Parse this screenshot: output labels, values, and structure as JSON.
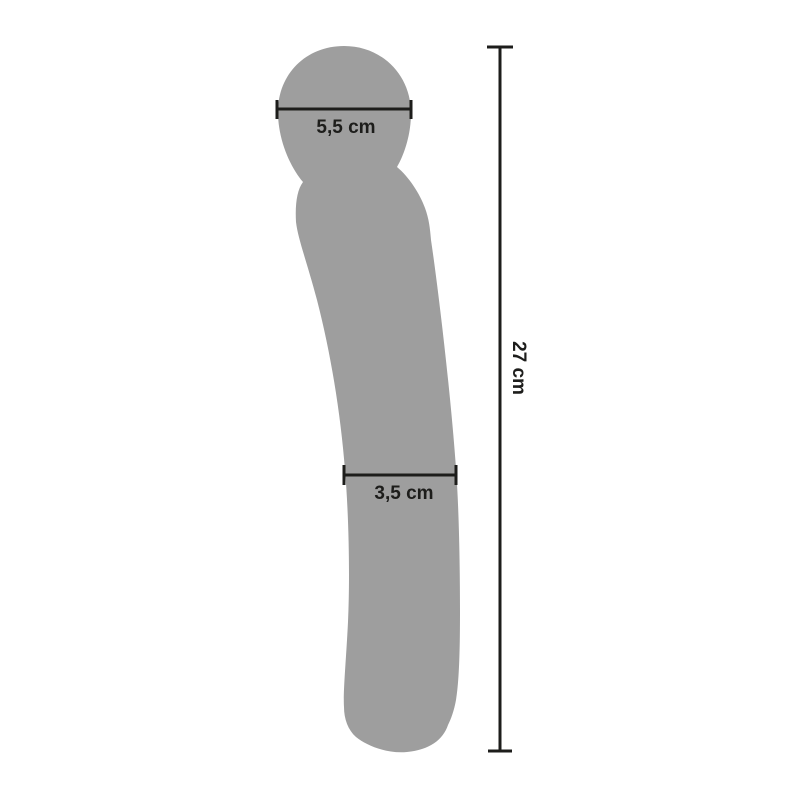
{
  "figure": {
    "type": "product-dimension-diagram",
    "background_color": "#ffffff",
    "silhouette_color": "#9e9e9e",
    "annotation_color": "#1d1d1b"
  },
  "measurements": {
    "head_width": {
      "label": "5,5 cm",
      "value": 5.5,
      "unit": "cm"
    },
    "shaft_width": {
      "label": "3,5 cm",
      "value": 3.5,
      "unit": "cm"
    },
    "total_length": {
      "label": "27 cm",
      "value": 27,
      "unit": "cm"
    }
  }
}
